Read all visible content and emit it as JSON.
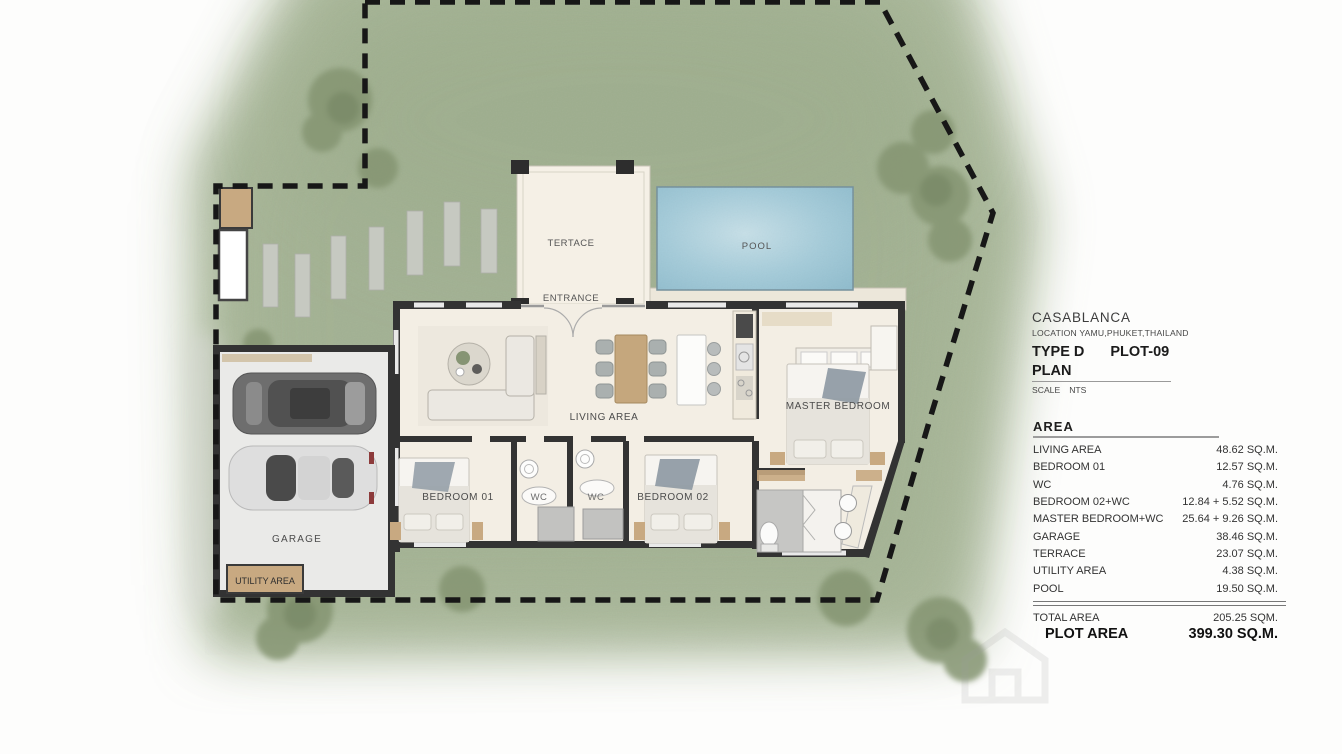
{
  "title_block": {
    "project": "CASABLANCA",
    "location": "LOCATION YAMU,PHUKET,THAILAND",
    "type_label": "TYPE D",
    "plot_label": "PLOT-09",
    "drawing_label": "PLAN",
    "scale_label": "SCALE",
    "scale_value": "NTS"
  },
  "area_table": {
    "header": "AREA",
    "rows": [
      {
        "label": "LIVING AREA",
        "value": "48.62 SQ.M."
      },
      {
        "label": "BEDROOM 01",
        "value": "12.57 SQ.M."
      },
      {
        "label": "WC",
        "value": "4.76 SQ.M."
      },
      {
        "label": "BEDROOM 02+WC",
        "value": "12.84 + 5.52 SQ.M."
      },
      {
        "label": "MASTER BEDROOM+WC",
        "value": "25.64 + 9.26 SQ.M."
      },
      {
        "label": "GARAGE",
        "value": "38.46 SQ.M."
      },
      {
        "label": "TERRACE",
        "value": "23.07 SQ.M."
      },
      {
        "label": "UTILITY AREA",
        "value": "4.38 SQ.M."
      },
      {
        "label": "POOL",
        "value": "19.50 SQ.M."
      }
    ],
    "total_label": "TOTAL AREA",
    "total_value": "205.25 SQM.",
    "plot_area_label": "PLOT AREA",
    "plot_area_value": "399.30 SQ.M."
  },
  "plan_labels": {
    "terrace": "TERTACE",
    "entrance": "ENTRANCE",
    "pool": "POOL",
    "living_area": "LIVING AREA",
    "master_bedroom": "MASTER BEDROOM",
    "bedroom_01": "BEDROOM 01",
    "bedroom_02": "BEDROOM 02",
    "wc_left": "WC",
    "wc_right": "WC",
    "garage": "GARAGE",
    "utility_area": "UTILITY AREA"
  },
  "colors": {
    "grass": "#a8b697",
    "tree": "#7f9070",
    "pool_water": "#9cc6d6",
    "floor": "#f3eee3",
    "wall": "#333333",
    "wood": "#c8a981",
    "stone": "#c6c9c1",
    "garage_floor": "#eaeae8",
    "boundary": "#1a1a1a",
    "text": "#3d3d3d"
  }
}
